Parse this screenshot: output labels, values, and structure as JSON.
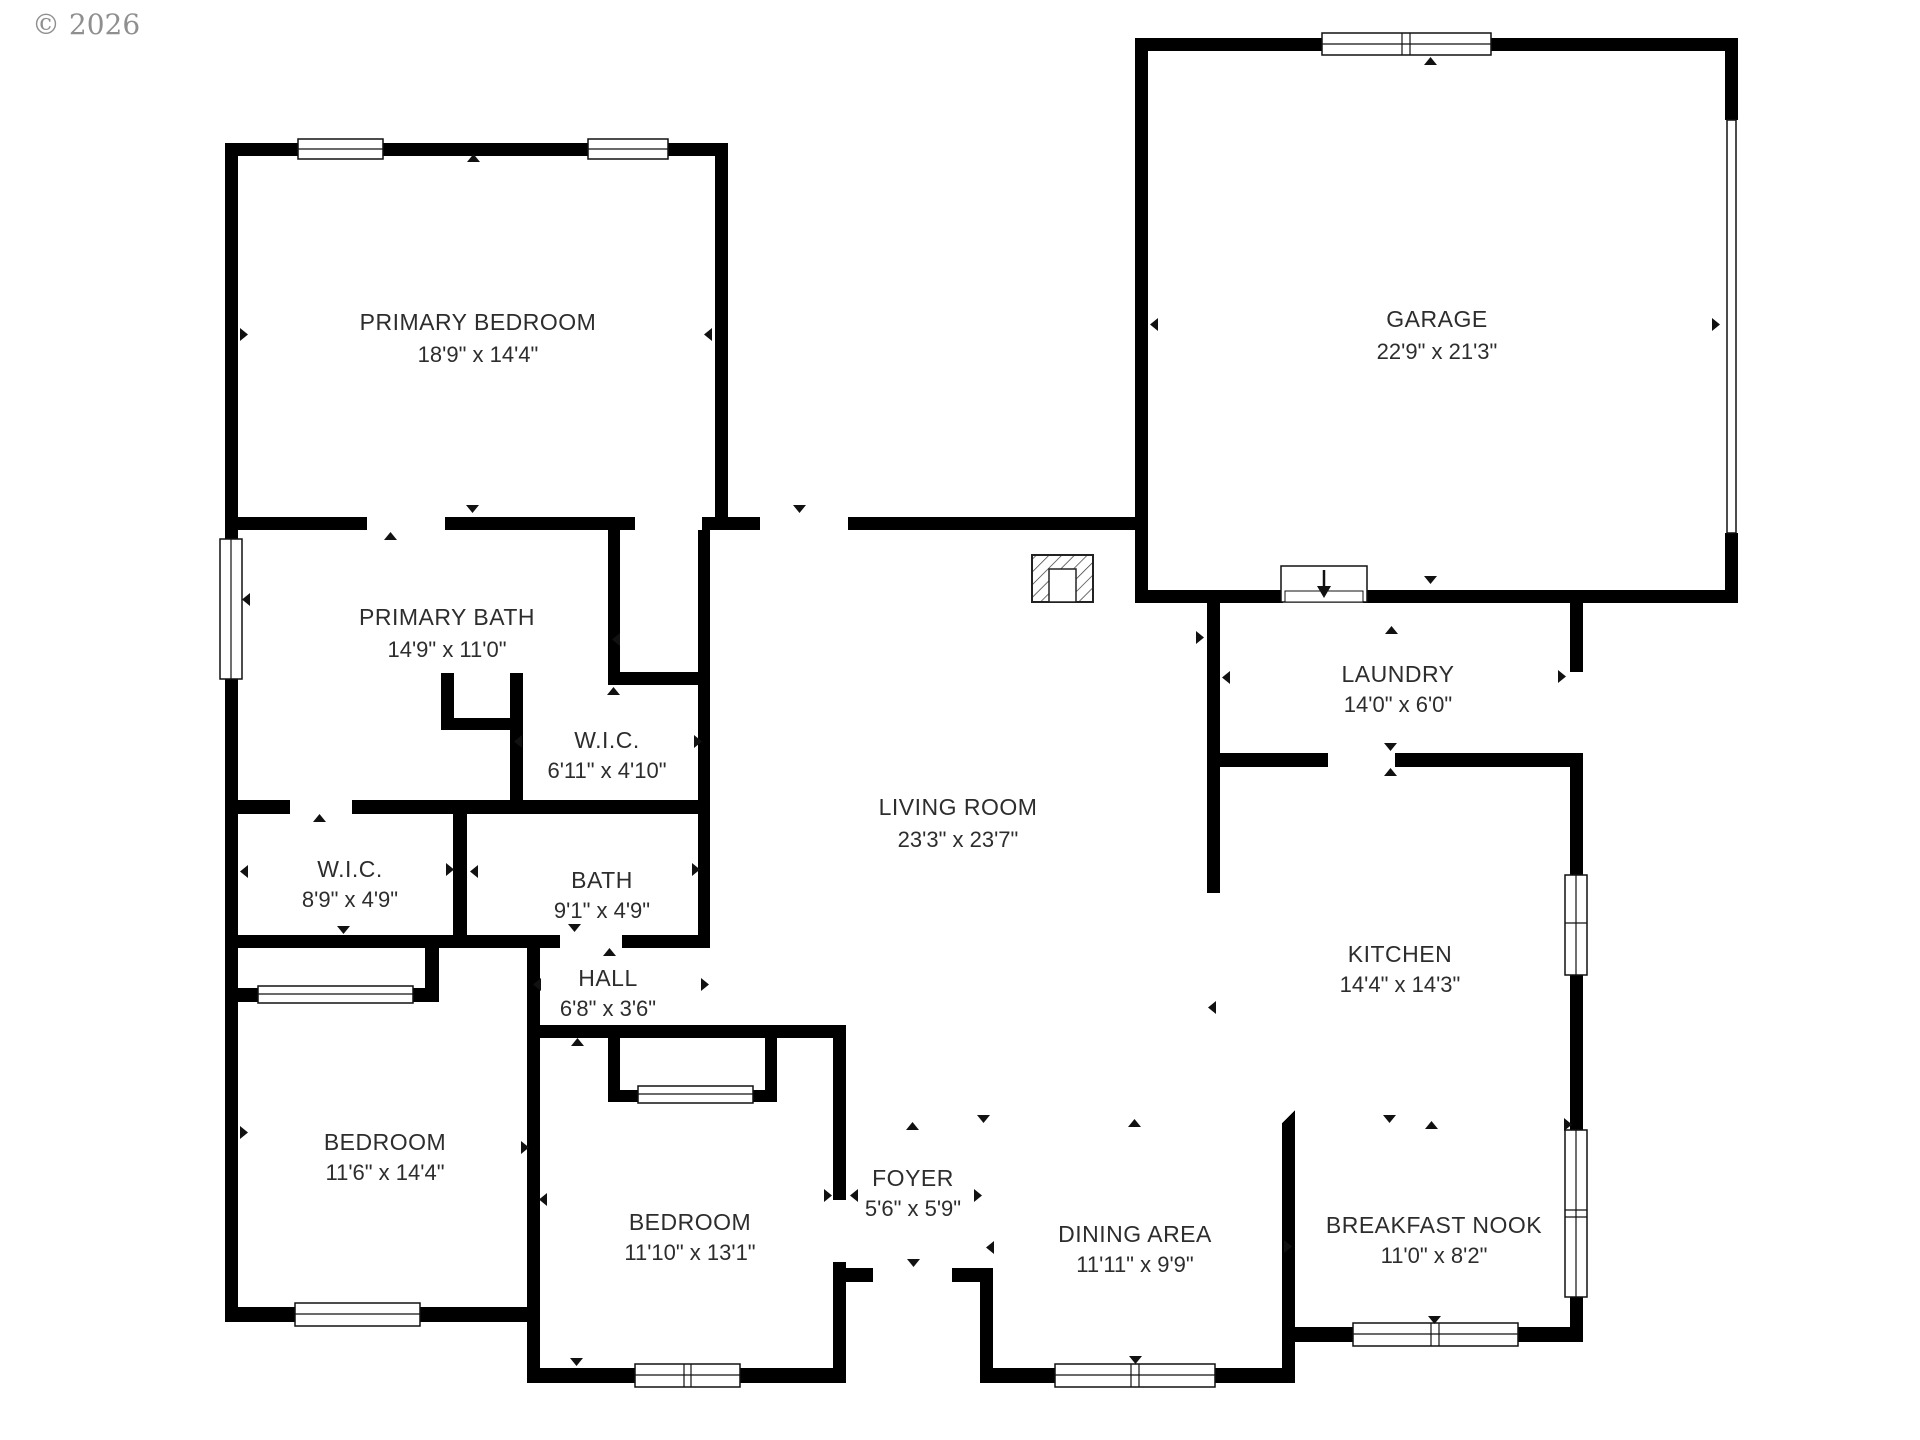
{
  "copyright": "© 2026",
  "colors": {
    "wall": "#000000",
    "label_text": "#2d2d2d",
    "copyright_text": "#8f8f8f",
    "background": "#ffffff"
  },
  "rooms": [
    {
      "id": "primary-bedroom",
      "name": "PRIMARY BEDROOM",
      "dims": "18'9\" x 14'4\""
    },
    {
      "id": "garage",
      "name": "GARAGE",
      "dims": "22'9\" x 21'3\""
    },
    {
      "id": "primary-bath",
      "name": "PRIMARY BATH",
      "dims": "14'9\" x 11'0\""
    },
    {
      "id": "wic-primary",
      "name": "W.I.C.",
      "dims": "6'11\" x 4'10\""
    },
    {
      "id": "wic-2",
      "name": "W.I.C.",
      "dims": "8'9\" x 4'9\""
    },
    {
      "id": "bath",
      "name": "BATH",
      "dims": "9'1\" x 4'9\""
    },
    {
      "id": "hall",
      "name": "HALL",
      "dims": "6'8\" x 3'6\""
    },
    {
      "id": "living-room",
      "name": "LIVING ROOM",
      "dims": "23'3\" x 23'7\""
    },
    {
      "id": "laundry",
      "name": "LAUNDRY",
      "dims": "14'0\" x 6'0\""
    },
    {
      "id": "kitchen",
      "name": "KITCHEN",
      "dims": "14'4\" x 14'3\""
    },
    {
      "id": "bedroom-1",
      "name": "BEDROOM",
      "dims": "11'6\" x 14'4\""
    },
    {
      "id": "bedroom-2",
      "name": "BEDROOM",
      "dims": "11'10\" x 13'1\""
    },
    {
      "id": "foyer",
      "name": "FOYER",
      "dims": "5'6\" x 5'9\""
    },
    {
      "id": "dining-area",
      "name": "DINING AREA",
      "dims": "11'11\" x 9'9\""
    },
    {
      "id": "breakfast-nook",
      "name": "BREAKFAST NOOK",
      "dims": "11'0\" x 8'2\""
    }
  ]
}
